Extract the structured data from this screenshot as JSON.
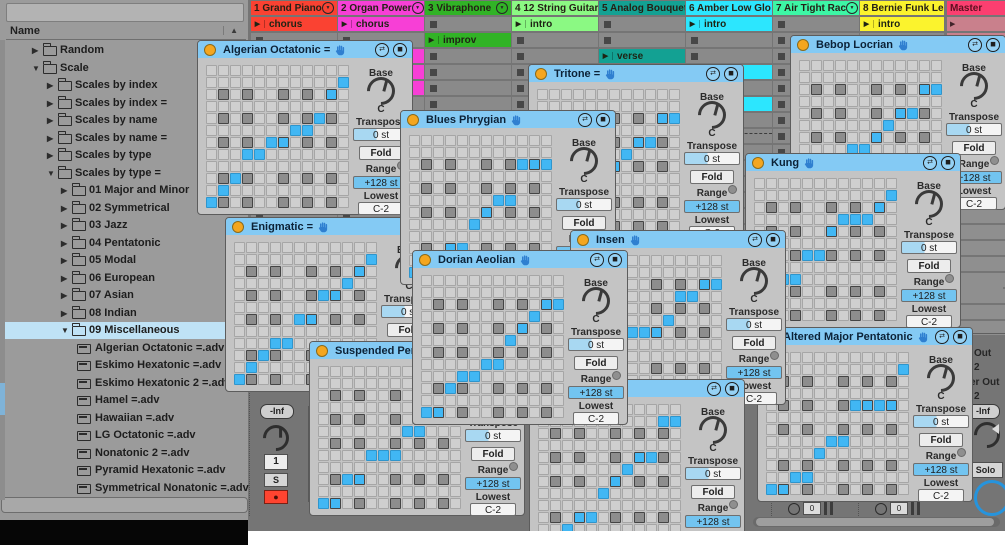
{
  "browser": {
    "name_header": "Name",
    "sort_arrow": "▲",
    "items": [
      {
        "label": "Random",
        "depth": 1,
        "arrow": "collapsed",
        "icon": "folder"
      },
      {
        "label": "Scale",
        "depth": 1,
        "arrow": "expanded",
        "icon": "folder"
      },
      {
        "label": "Scales by index",
        "depth": 2,
        "arrow": "collapsed",
        "icon": "folder"
      },
      {
        "label": "Scales by index =",
        "depth": 2,
        "arrow": "collapsed",
        "icon": "folder"
      },
      {
        "label": "Scales by name",
        "depth": 2,
        "arrow": "collapsed",
        "icon": "folder"
      },
      {
        "label": "Scales by name =",
        "depth": 2,
        "arrow": "collapsed",
        "icon": "folder"
      },
      {
        "label": "Scales by type",
        "depth": 2,
        "arrow": "collapsed",
        "icon": "folder"
      },
      {
        "label": "Scales by type =",
        "depth": 2,
        "arrow": "expanded",
        "icon": "folder"
      },
      {
        "label": "01 Major and Minor",
        "depth": 3,
        "arrow": "collapsed",
        "icon": "folder"
      },
      {
        "label": "02 Symmetrical",
        "depth": 3,
        "arrow": "collapsed",
        "icon": "folder"
      },
      {
        "label": "03 Jazz",
        "depth": 3,
        "arrow": "collapsed",
        "icon": "folder"
      },
      {
        "label": "04 Pentatonic",
        "depth": 3,
        "arrow": "collapsed",
        "icon": "folder"
      },
      {
        "label": "05 Modal",
        "depth": 3,
        "arrow": "collapsed",
        "icon": "folder"
      },
      {
        "label": "06 European",
        "depth": 3,
        "arrow": "collapsed",
        "icon": "folder"
      },
      {
        "label": "07 Asian",
        "depth": 3,
        "arrow": "collapsed",
        "icon": "folder"
      },
      {
        "label": "08 Indian",
        "depth": 3,
        "arrow": "collapsed",
        "icon": "folder"
      },
      {
        "label": "09 Miscellaneous",
        "depth": 3,
        "arrow": "expanded",
        "icon": "folder",
        "selected": true
      },
      {
        "label": "Algerian Octatonic =.adv",
        "depth": 4,
        "arrow": "none",
        "icon": "file"
      },
      {
        "label": "Eskimo Hexatonic =.adv",
        "depth": 4,
        "arrow": "none",
        "icon": "file"
      },
      {
        "label": "Eskimo Hexatonic 2 =.adv",
        "depth": 4,
        "arrow": "none",
        "icon": "file"
      },
      {
        "label": "Hamel =.adv",
        "depth": 4,
        "arrow": "none",
        "icon": "file"
      },
      {
        "label": "Hawaiian =.adv",
        "depth": 4,
        "arrow": "none",
        "icon": "file"
      },
      {
        "label": "LG Octatonic =.adv",
        "depth": 4,
        "arrow": "none",
        "icon": "file"
      },
      {
        "label": "Nonatonic 2 =.adv",
        "depth": 4,
        "arrow": "none",
        "icon": "file"
      },
      {
        "label": "Pyramid Hexatonic =.adv",
        "depth": 4,
        "arrow": "none",
        "icon": "file"
      },
      {
        "label": "Symmetrical Nonatonic =.adv",
        "depth": 4,
        "arrow": "none",
        "icon": "file"
      },
      {
        "label": "Velocity",
        "depth": 1,
        "arrow": "collapsed",
        "icon": "folder"
      }
    ]
  },
  "session": {
    "tracks": [
      {
        "name": "1 Grand Piano",
        "color": "#fa4232",
        "dropdown": true,
        "x": 3,
        "w": 86,
        "clips": [
          {
            "row": 0,
            "label": "chorus"
          }
        ]
      },
      {
        "name": "2 Organ Power",
        "color": "#f73fd6",
        "dropdown": true,
        "x": 90,
        "w": 86,
        "clips": [
          {
            "row": 0,
            "label": "chorus"
          },
          {
            "row": 2,
            "label": ""
          },
          {
            "row": 3,
            "label": ""
          },
          {
            "row": 4,
            "label": ""
          }
        ]
      },
      {
        "name": "3 Vibraphone",
        "color": "#31b326",
        "dropdown": true,
        "x": 177,
        "w": 86,
        "clips": [
          {
            "row": 1,
            "label": "improv"
          }
        ]
      },
      {
        "name": "4 12 String Guitar",
        "color": "#8bf983",
        "dropdown": false,
        "x": 264,
        "w": 86,
        "clips": [
          {
            "row": 0,
            "label": "intro"
          }
        ]
      },
      {
        "name": "5 Analog Bouquet",
        "color": "#13a193",
        "dropdown": false,
        "x": 351,
        "w": 86,
        "clips": [
          {
            "row": 2,
            "label": "verse"
          }
        ]
      },
      {
        "name": "6 Amber Low Glo",
        "color": "#2ce6fe",
        "dropdown": false,
        "x": 438,
        "w": 86,
        "clips": [
          {
            "row": 0,
            "label": "intro"
          },
          {
            "row": 3,
            "label": ""
          },
          {
            "row": 5,
            "label": ""
          }
        ]
      },
      {
        "name": "7 Air Tight Rac",
        "color": "#3df6a5",
        "dropdown": true,
        "x": 525,
        "w": 86,
        "clips": []
      },
      {
        "name": "8 Bernie Funk Lea",
        "color": "#fbf32d",
        "dropdown": false,
        "x": 612,
        "w": 84,
        "clips": [
          {
            "row": 0,
            "label": "intro"
          }
        ]
      }
    ],
    "master": {
      "name": "Master",
      "color": "#fb3f70",
      "x": 699,
      "w": 58
    },
    "master_mixer": {
      "out_a": "Out",
      "out_a_val": "2",
      "out_b": "er Out",
      "out_b_val": "2",
      "volume": "-Inf",
      "solo": "Solo"
    },
    "track1_mixer": {
      "volume": "-Inf",
      "input": "1",
      "solo": "S"
    },
    "meter_value": "0"
  },
  "window_params": {
    "base_label": "Base",
    "base_value": "C",
    "transpose_label": "Transpose",
    "transpose_value": "0 st",
    "fold_label": "Fold",
    "range_label": "Range",
    "range_value": "+128 st",
    "lowest_label": "Lowest",
    "lowest_value": "C-2"
  },
  "grid_ref": {
    "size": 12,
    "rows": [
      3,
      5,
      7,
      10,
      12
    ],
    "cols": [
      2,
      4,
      7,
      9,
      11
    ]
  },
  "windows": [
    {
      "id": "tritone",
      "title": "Tritone =",
      "x": 528,
      "y": 64,
      "z": 1,
      "blue": [
        [
          12,
          1
        ],
        [
          12,
          2
        ],
        [
          10,
          3
        ],
        [
          10,
          4
        ],
        [
          8,
          5
        ],
        [
          8,
          6
        ],
        [
          7,
          7
        ],
        [
          6,
          8
        ],
        [
          5,
          9
        ],
        [
          5,
          10
        ],
        [
          3,
          11
        ],
        [
          3,
          12
        ]
      ]
    },
    {
      "id": "bebop-locrian",
      "title": "Bebop Locrian",
      "x": 790,
      "y": 35,
      "z": 2,
      "blue": [
        [
          12,
          1
        ],
        [
          11,
          2
        ],
        [
          10,
          3
        ],
        [
          10,
          4
        ],
        [
          8,
          5
        ],
        [
          8,
          6
        ],
        [
          7,
          7
        ],
        [
          6,
          8
        ],
        [
          5,
          9
        ],
        [
          5,
          10
        ],
        [
          3,
          11
        ],
        [
          3,
          12
        ]
      ]
    },
    {
      "id": "algerian-octatonic",
      "title": "Algerian Octatonic =",
      "x": 197,
      "y": 40,
      "z": 3,
      "blue": [
        [
          12,
          1
        ],
        [
          11,
          2
        ],
        [
          10,
          3
        ],
        [
          8,
          4
        ],
        [
          8,
          5
        ],
        [
          7,
          6
        ],
        [
          7,
          7
        ],
        [
          6,
          8
        ],
        [
          6,
          9
        ],
        [
          5,
          10
        ],
        [
          3,
          11
        ],
        [
          2,
          12
        ]
      ]
    },
    {
      "id": "enigmatic",
      "title": "Enigmatic =",
      "x": 225,
      "y": 217,
      "z": 4,
      "blue": [
        [
          12,
          1
        ],
        [
          11,
          2
        ],
        [
          10,
          3
        ],
        [
          9,
          4
        ],
        [
          9,
          5
        ],
        [
          7,
          6
        ],
        [
          7,
          7
        ],
        [
          5,
          8
        ],
        [
          5,
          9
        ],
        [
          4,
          10
        ],
        [
          3,
          11
        ],
        [
          2,
          12
        ]
      ]
    },
    {
      "id": "blues-phrygian",
      "title": "Blues Phrygian",
      "x": 400,
      "y": 110,
      "z": 5,
      "blue": [
        [
          12,
          1
        ],
        [
          12,
          2
        ],
        [
          11,
          3
        ],
        [
          10,
          4
        ],
        [
          10,
          5
        ],
        [
          8,
          6
        ],
        [
          7,
          7
        ],
        [
          6,
          8
        ],
        [
          6,
          9
        ],
        [
          3,
          10
        ],
        [
          3,
          11
        ],
        [
          3,
          12
        ]
      ]
    },
    {
      "id": "kung",
      "title": "Kung",
      "x": 745,
      "y": 153,
      "z": 6,
      "blue": [
        [
          12,
          1
        ],
        [
          12,
          2
        ],
        [
          9,
          3
        ],
        [
          9,
          4
        ],
        [
          7,
          5
        ],
        [
          7,
          6
        ],
        [
          5,
          7
        ],
        [
          4,
          8
        ],
        [
          4,
          9
        ],
        [
          4,
          10
        ],
        [
          3,
          11
        ],
        [
          2,
          12
        ]
      ]
    },
    {
      "id": "altered-major-pentatonic",
      "title": "Altered Major Pentatonic",
      "x": 757,
      "y": 327,
      "z": 7,
      "blue": [
        [
          12,
          1
        ],
        [
          12,
          2
        ],
        [
          11,
          3
        ],
        [
          11,
          4
        ],
        [
          9,
          5
        ],
        [
          8,
          6
        ],
        [
          8,
          7
        ],
        [
          5,
          8
        ],
        [
          5,
          9
        ],
        [
          5,
          10
        ],
        [
          5,
          11
        ],
        [
          2,
          12
        ]
      ]
    },
    {
      "id": "insen",
      "title": "Insen",
      "x": 570,
      "y": 230,
      "z": 8,
      "blue": [
        [
          12,
          1
        ],
        [
          12,
          2
        ],
        [
          10,
          3
        ],
        [
          10,
          4
        ],
        [
          7,
          5
        ],
        [
          7,
          6
        ],
        [
          7,
          7
        ],
        [
          6,
          8
        ],
        [
          4,
          9
        ],
        [
          4,
          10
        ],
        [
          3,
          11
        ],
        [
          3,
          12
        ]
      ]
    },
    {
      "id": "hidden-title",
      "title": "",
      "x": 529,
      "y": 379,
      "z": 9,
      "blue": [
        [
          12,
          1
        ],
        [
          12,
          2
        ],
        [
          11,
          3
        ],
        [
          10,
          4
        ],
        [
          10,
          5
        ],
        [
          8,
          6
        ],
        [
          7,
          7
        ],
        [
          6,
          8
        ],
        [
          5,
          9
        ],
        [
          5,
          10
        ],
        [
          2,
          11
        ],
        [
          2,
          12
        ]
      ]
    },
    {
      "id": "suspended-pentatonic",
      "title": "Suspended Pentatonic",
      "x": 309,
      "y": 341,
      "z": 10,
      "blue": [
        [
          12,
          1
        ],
        [
          12,
          2
        ],
        [
          10,
          3
        ],
        [
          10,
          4
        ],
        [
          8,
          5
        ],
        [
          8,
          6
        ],
        [
          8,
          7
        ],
        [
          6,
          8
        ],
        [
          6,
          9
        ],
        [
          3,
          10
        ],
        [
          3,
          11
        ],
        [
          3,
          12
        ]
      ]
    },
    {
      "id": "dorian-aeolian",
      "title": "Dorian Aeolian",
      "x": 412,
      "y": 250,
      "z": 11,
      "blue": [
        [
          12,
          1
        ],
        [
          12,
          2
        ],
        [
          10,
          3
        ],
        [
          9,
          4
        ],
        [
          9,
          5
        ],
        [
          8,
          6
        ],
        [
          8,
          7
        ],
        [
          6,
          8
        ],
        [
          5,
          9
        ],
        [
          4,
          10
        ],
        [
          3,
          11
        ],
        [
          3,
          12
        ]
      ]
    }
  ]
}
